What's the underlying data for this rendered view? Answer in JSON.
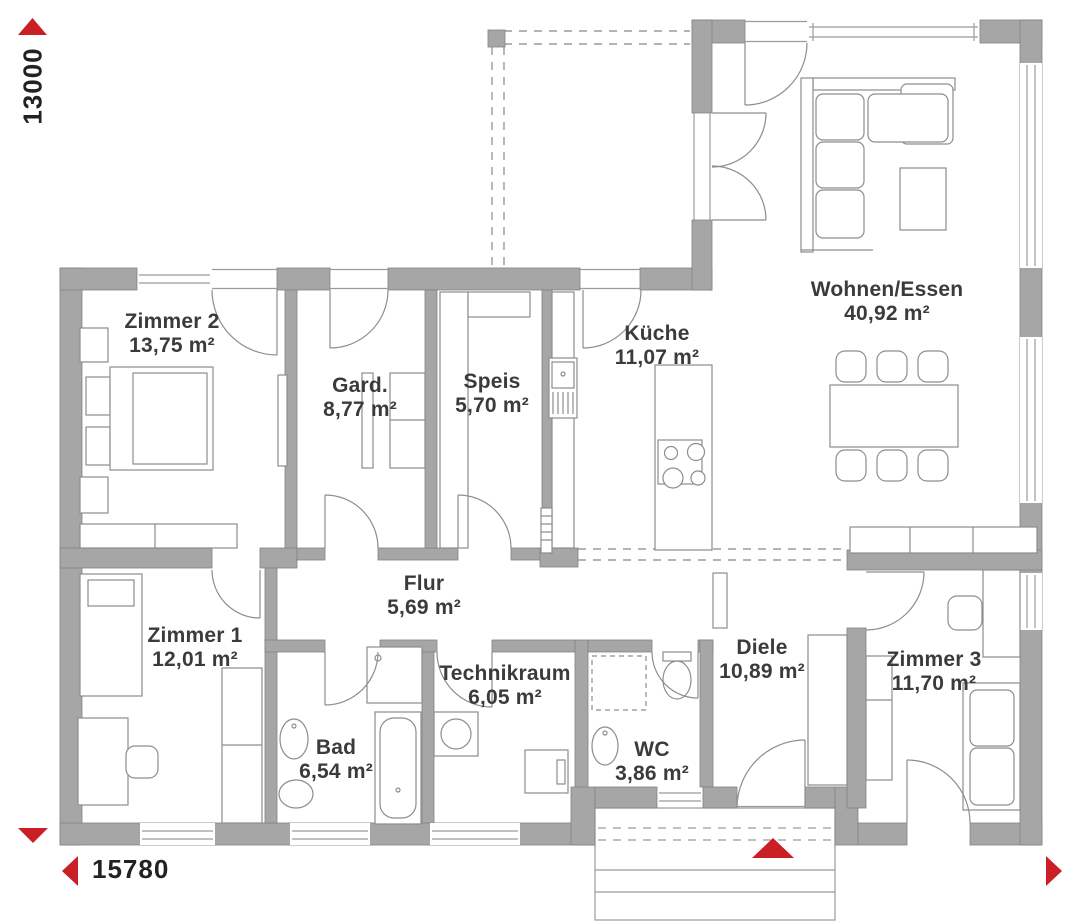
{
  "plan": {
    "dimensions": {
      "height_label": "13000",
      "width_label": "15780"
    },
    "rooms": [
      {
        "id": "zimmer2",
        "name": "Zimmer 2",
        "area": "13,75 m²"
      },
      {
        "id": "gard",
        "name": "Gard.",
        "area": "8,77 m²"
      },
      {
        "id": "speis",
        "name": "Speis",
        "area": "5,70 m²"
      },
      {
        "id": "kueche",
        "name": "Küche",
        "area": "11,07 m²"
      },
      {
        "id": "wohnen",
        "name": "Wohnen/Essen",
        "area": "40,92 m²"
      },
      {
        "id": "zimmer1",
        "name": "Zimmer 1",
        "area": "12,01 m²"
      },
      {
        "id": "flur",
        "name": "Flur",
        "area": "5,69 m²"
      },
      {
        "id": "bad",
        "name": "Bad",
        "area": "6,54 m²"
      },
      {
        "id": "technikraum",
        "name": "Technikraum",
        "area": "6,05 m²"
      },
      {
        "id": "wc",
        "name": "WC",
        "area": "3,86 m²"
      },
      {
        "id": "diele",
        "name": "Diele",
        "area": "10,89 m²"
      },
      {
        "id": "zimmer3",
        "name": "Zimmer 3",
        "area": "11,70 m²"
      }
    ],
    "markers": {
      "height_arrow": "up-triangle",
      "width_arrow": "left-triangle",
      "corner_arrows": [
        "down-triangle",
        "right-triangle"
      ],
      "entrance_arrow": "up-triangle"
    },
    "colors": {
      "wall": "#a6a6a6",
      "accent_red": "#cb1f26",
      "text": "#3b3b3b",
      "line": "#8d8d8d"
    }
  }
}
